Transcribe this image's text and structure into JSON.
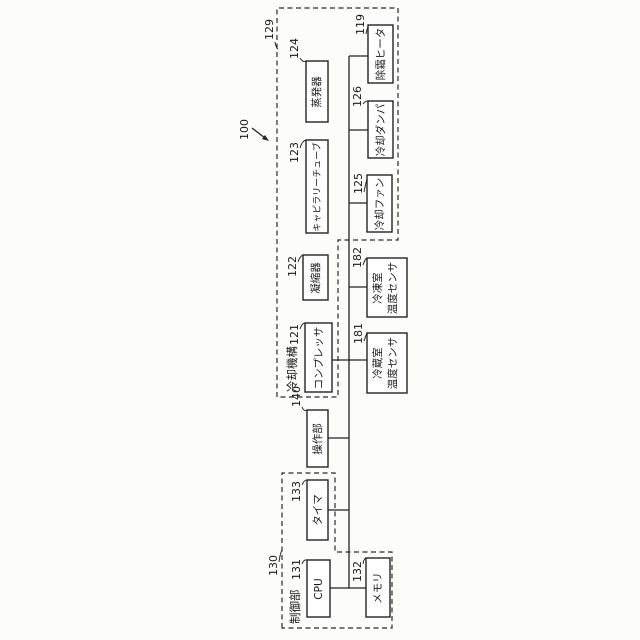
{
  "figure": {
    "overall_ref": "100",
    "groups": {
      "cooling_mechanism": {
        "ref": "129",
        "label": "冷却機構"
      },
      "control_unit": {
        "ref": "130",
        "label": "制御部"
      }
    },
    "boxes": {
      "cpu": {
        "ref": "131",
        "label": "CPU"
      },
      "memory": {
        "ref": "132",
        "label": "メモリ"
      },
      "timer": {
        "ref": "133",
        "label": "タイマ"
      },
      "operation": {
        "ref": "140",
        "label": "操作部"
      },
      "compressor": {
        "ref": "121",
        "label": "コンプレッサ"
      },
      "condenser": {
        "ref": "122",
        "label": "凝縮器"
      },
      "capillary": {
        "ref": "123",
        "label": "キャピラリーチューブ"
      },
      "evaporator": {
        "ref": "124",
        "label": "蒸発器"
      },
      "fridge_sensor": {
        "ref": "181",
        "line1": "冷蔵室",
        "line2": "温度センサ"
      },
      "freezer_sensor": {
        "ref": "182",
        "line1": "冷凍室",
        "line2": "温度センサ"
      },
      "fan": {
        "ref": "125",
        "label": "冷却ファン"
      },
      "damper": {
        "ref": "126",
        "label": "冷却ダンパ"
      },
      "heater": {
        "ref": "119",
        "label": "除霜ヒータ"
      }
    },
    "colors": {
      "line": "#232323",
      "paper": "#fcfcfb"
    }
  }
}
